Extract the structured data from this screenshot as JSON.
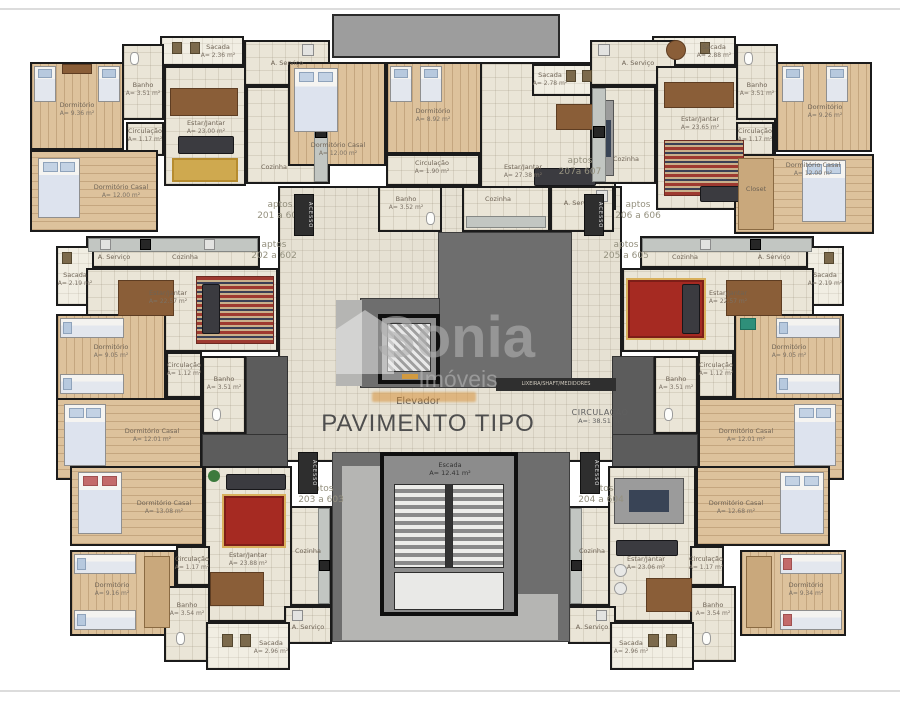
{
  "floor": {
    "title": "PAVIMENTO TIPO"
  },
  "watermark": {
    "brand": "Sonia",
    "sub": "Imóveis"
  },
  "core": {
    "elevator": "Elevador",
    "stairs_name": "Escada",
    "stairs_area": "A= 12.41 m²",
    "circulation_name": "CIRCULAÇÃO",
    "circulation_area": "A=: 38.51 m²",
    "access": "ACESSO",
    "shaft": "LIXEIRA/SHAFT/MEDIDORES"
  },
  "apartments": {
    "a201": {
      "l1": "aptos",
      "l2": "201 a 601",
      "rooms": {
        "dorm": {
          "name": "Dormitório",
          "area": "A= 9.36 m²"
        },
        "casal": {
          "name": "Dormitório Casal",
          "area": "A= 12.00 m²"
        },
        "estar": {
          "name": "Estar/Jantar",
          "area": "A= 23.00 m²"
        },
        "banho": {
          "name": "Banho",
          "area": "A= 3.51 m²"
        },
        "circ": {
          "name": "Circulação",
          "area": "A= 1.17 m²"
        },
        "sacada": {
          "name": "Sacada",
          "area": "A= 2.36 m²"
        },
        "cozinha": {
          "name": "Cozinha"
        },
        "aserv": {
          "name": "A. Serviço"
        }
      }
    },
    "a207": {
      "l1": "aptos",
      "l2": "207a 607",
      "rooms": {
        "casal": {
          "name": "Dormitório Casal",
          "area": "A= 12.00 m²"
        },
        "dorm": {
          "name": "Dormitório",
          "area": "A= 8.92 m²"
        },
        "estar": {
          "name": "Estar/Jantar",
          "area": "A= 27.38 m²"
        },
        "sacada": {
          "name": "Sacada",
          "area": "A= 2.78 m²"
        },
        "circ": {
          "name": "Circulação",
          "area": "A= 1.90 m²"
        },
        "banho": {
          "name": "Banho",
          "area": "A= 3.52 m²"
        },
        "cozinha": {
          "name": "Cozinha"
        },
        "aserv": {
          "name": "A. Serviço"
        }
      }
    },
    "a206": {
      "l1": "aptos",
      "l2": "206 a 606",
      "rooms": {
        "sacada": {
          "name": "Sacada",
          "area": "A= 2.88 m²"
        },
        "estar": {
          "name": "Estar/Jantar",
          "area": "A= 23.65 m²"
        },
        "banho": {
          "name": "Banho",
          "area": "A= 3.51 m²"
        },
        "circ": {
          "name": "Circulação",
          "area": "A= 1.17 m²"
        },
        "dorm": {
          "name": "Dormitório",
          "area": "A= 9.26 m²"
        },
        "casal": {
          "name": "Dormitório Casal",
          "area": "A= 12.00 m²"
        },
        "closet": {
          "name": "Closet"
        },
        "cozinha": {
          "name": "Cozinha"
        },
        "aserv": {
          "name": "A. Serviço"
        }
      }
    },
    "a202": {
      "l1": "aptos",
      "l2": "202 a 602",
      "rooms": {
        "sacada": {
          "name": "Sacada",
          "area": "A= 2.19 m²"
        },
        "estar": {
          "name": "Estar/Jantar",
          "area": "A= 22.57 m²"
        },
        "dorm": {
          "name": "Dormitório",
          "area": "A= 9.05 m²"
        },
        "circ": {
          "name": "Circulação",
          "area": "A= 1.12 m²"
        },
        "banho": {
          "name": "Banho",
          "area": "A= 3.51 m²"
        },
        "casal": {
          "name": "Dormitório Casal",
          "area": "A= 12.01 m²"
        },
        "cozinha": {
          "name": "Cozinha"
        },
        "aserv": {
          "name": "A. Serviço"
        }
      }
    },
    "a205": {
      "l1": "aptos",
      "l2": "205 a 605",
      "rooms": {
        "sacada": {
          "name": "Sacada",
          "area": "A= 2.19 m²"
        },
        "estar": {
          "name": "Estar/Jantar",
          "area": "A= 22.57 m²"
        },
        "dorm": {
          "name": "Dormitório",
          "area": "A= 9.05 m²"
        },
        "circ": {
          "name": "Circulação",
          "area": "A= 1.12 m²"
        },
        "banho": {
          "name": "Banho",
          "area": "A= 3.51 m²"
        },
        "casal": {
          "name": "Dormitório Casal",
          "area": "A= 12.01 m²"
        },
        "cozinha": {
          "name": "Cozinha"
        },
        "aserv": {
          "name": "A. Serviço"
        }
      }
    },
    "a203": {
      "l1": "aptos",
      "l2": "203 a 603",
      "rooms": {
        "casal": {
          "name": "Dormitório Casal",
          "area": "A= 13.08 m²"
        },
        "dorm": {
          "name": "Dormitório",
          "area": "A= 9.16 m²"
        },
        "circ": {
          "name": "Circulação",
          "area": "A= 1.17 m²"
        },
        "banho": {
          "name": "Banho",
          "area": "A= 3.54 m²"
        },
        "estar": {
          "name": "Estar/Jantar",
          "area": "A= 23.88 m²"
        },
        "sacada": {
          "name": "Sacada",
          "area": "A= 2.96 m²"
        },
        "cozinha": {
          "name": "Cozinha"
        },
        "aserv": {
          "name": "A. Serviço"
        }
      }
    },
    "a204": {
      "l1": "aptos",
      "l2": "204 a 604",
      "rooms": {
        "casal": {
          "name": "Dormitório Casal",
          "area": "A= 12.68 m²"
        },
        "dorm": {
          "name": "Dormitório",
          "area": "A= 9.34 m²"
        },
        "circ": {
          "name": "Circulação",
          "area": "A= 1.17 m²"
        },
        "banho": {
          "name": "Banho",
          "area": "A= 3.54 m²"
        },
        "estar": {
          "name": "Estar/Jantar",
          "area": "A= 23.06 m²"
        },
        "sacada": {
          "name": "Sacada",
          "area": "A= 2.96 m²"
        },
        "cozinha": {
          "name": "Cozinha"
        },
        "aserv": {
          "name": "A. Serviço"
        }
      }
    }
  }
}
